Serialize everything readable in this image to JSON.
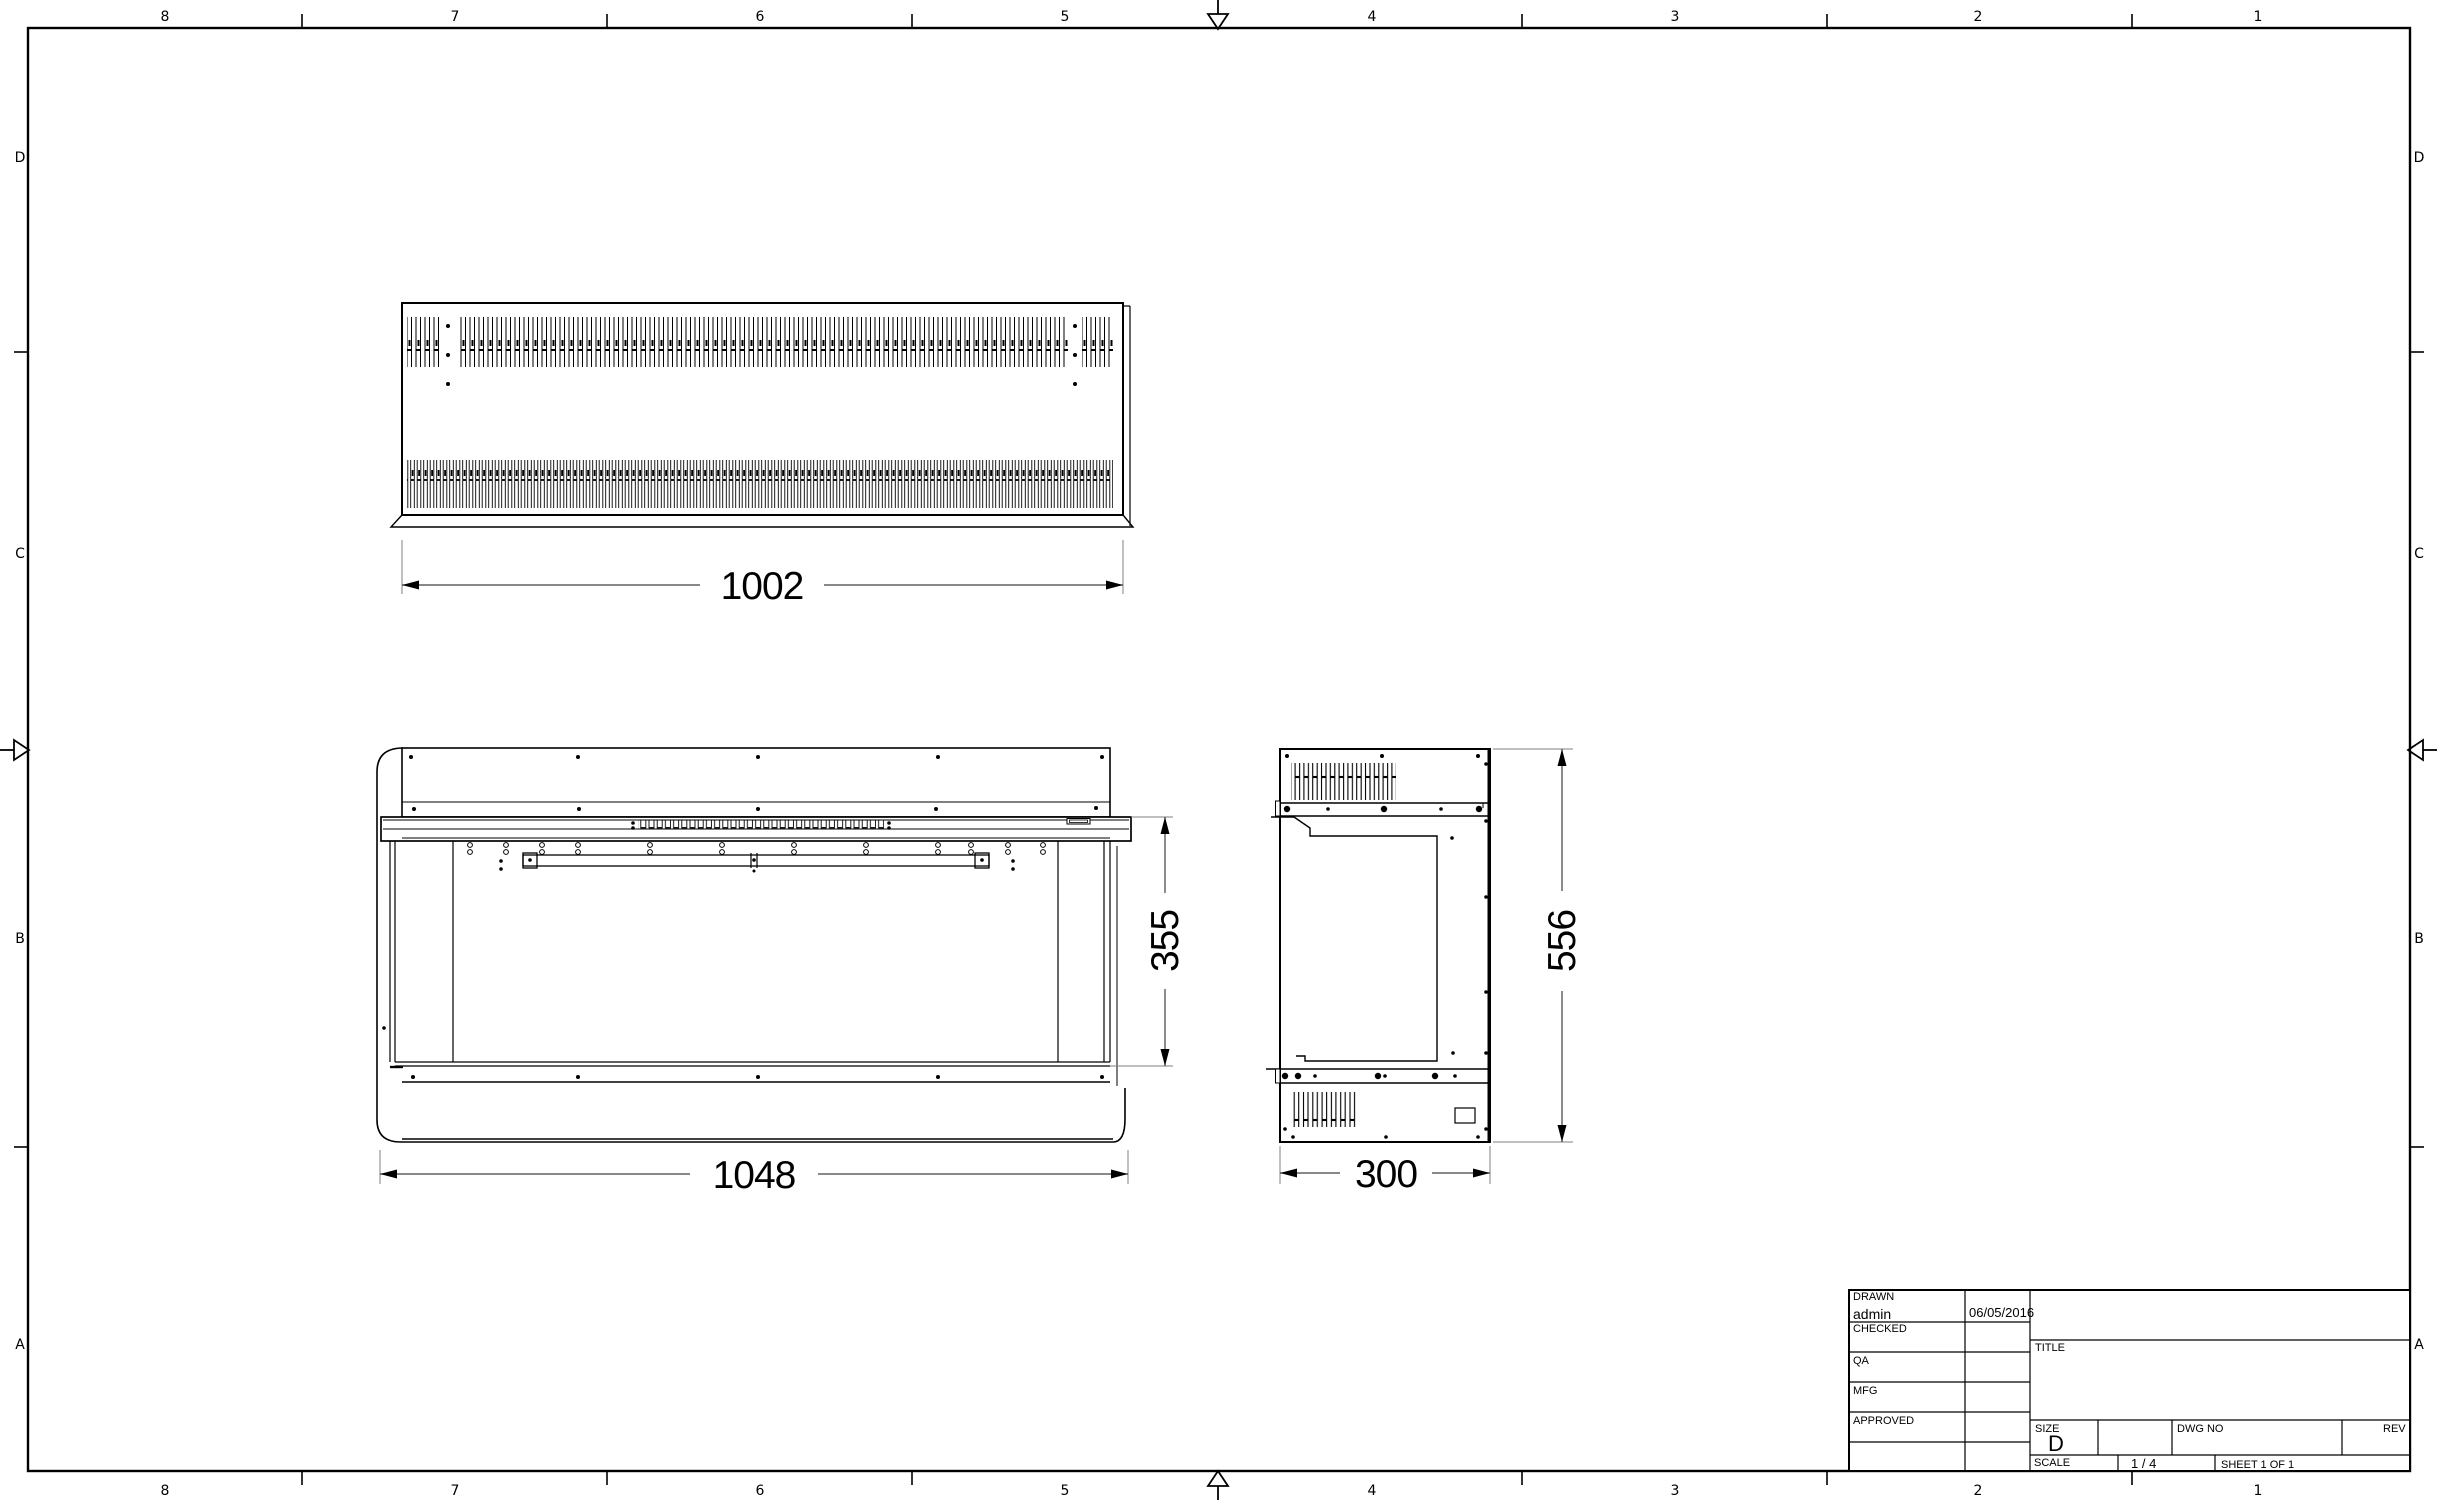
{
  "sheet": {
    "zone_columns": [
      "8",
      "7",
      "6",
      "5",
      "4",
      "3",
      "2",
      "1"
    ],
    "zone_rows": [
      "D",
      "C",
      "B",
      "A"
    ]
  },
  "dimensions": {
    "top_width": "1002",
    "front_width": "1048",
    "front_height": "355",
    "side_width": "300",
    "side_height": "556"
  },
  "title_block": {
    "drawn_label": "DRAWN",
    "drawn_value": "admin",
    "drawn_date": "06/05/2016",
    "checked_label": "CHECKED",
    "qa_label": "QA",
    "mfg_label": "MFG",
    "approved_label": "APPROVED",
    "title_label": "TITLE",
    "size_label": "SIZE",
    "size_value": "D",
    "dwg_label": "DWG NO",
    "rev_label": "REV",
    "scale_label": "SCALE",
    "scale_value": "1 / 4",
    "sheet_text": "SHEET 1  OF 1"
  },
  "colors": {
    "line": "#000000",
    "ext_line": "#808080",
    "background": "#ffffff"
  }
}
